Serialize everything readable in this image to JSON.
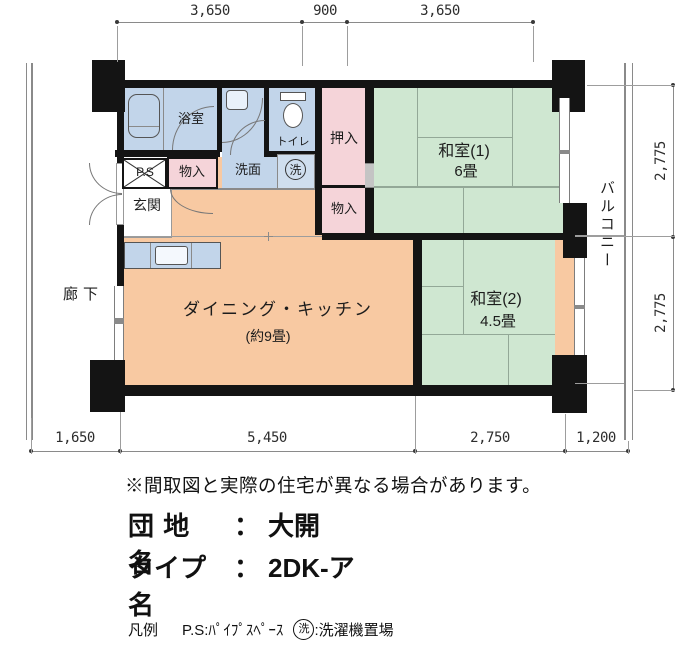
{
  "dimensions": {
    "top": [
      "3,650",
      "900",
      "3,650"
    ],
    "right": [
      "2,775",
      "2,775"
    ],
    "bottom": [
      "1,650",
      "5,450",
      "2,750",
      "1,200"
    ]
  },
  "rooms": {
    "bath": "浴室",
    "toilet": "トイレ",
    "washroom": "洗面",
    "washer_mark": "洗",
    "pipe_space": "P.S",
    "storage_entry": "物入",
    "closet_oshiire": "押入",
    "storage_hall": "物入",
    "entrance": "玄関",
    "corridor": "廊下",
    "balcony": "バルコニー",
    "dk_name": "ダイニング・キッチン",
    "dk_size": "(約9畳)",
    "japanese_room_1": "和室(1)",
    "japanese_room_1_size": "6畳",
    "japanese_room_2": "和室(2)",
    "japanese_room_2_size": "4.5畳"
  },
  "footer": {
    "note": "※間取図と実際の住宅が異なる場合があります。",
    "estate_label": "団 地 名",
    "colon": "：",
    "estate_value": "大開",
    "type_label": "タイプ名",
    "type_value": "2DK-ア",
    "legend_title": "凡例",
    "legend_ps": "P.S:ﾊﾟｲﾌﾟｽﾍﾟｰｽ",
    "legend_washer_mark": "洗",
    "legend_washer_text": ":洗濯機置場"
  },
  "colors": {
    "wall": "#141414",
    "tatami_green": "#cfe7d1",
    "dk_orange": "#f8c9a2",
    "closet_pink": "#f5d4d9",
    "wet_blue": "#c2d5ea",
    "washer_blue": "#cfdeee"
  }
}
